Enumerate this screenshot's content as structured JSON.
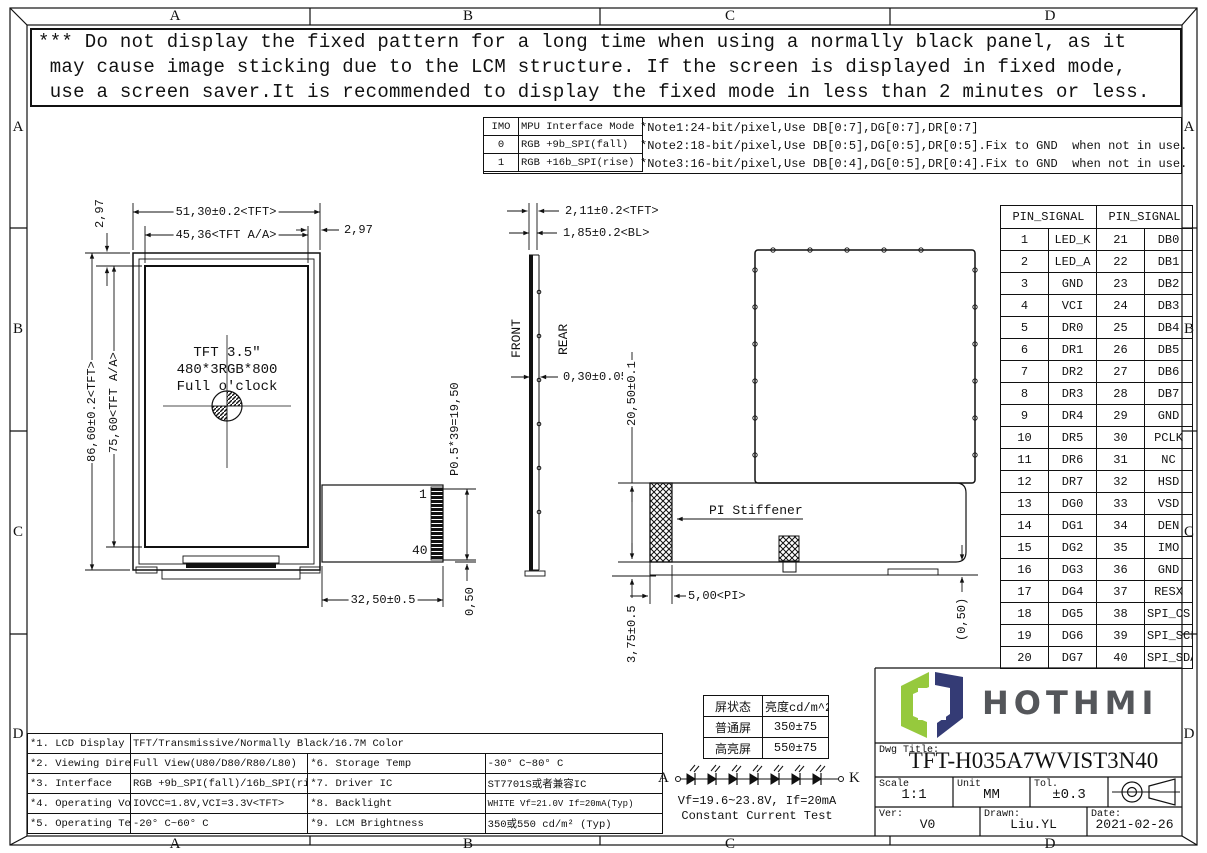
{
  "border": {
    "top": [
      "A",
      "B",
      "C",
      "D"
    ],
    "bottom": [
      "A",
      "B",
      "C",
      "D"
    ],
    "left": [
      "A",
      "B",
      "C",
      "D"
    ],
    "right": [
      "A",
      "B",
      "C",
      "D"
    ]
  },
  "warning": {
    "lines": [
      "*** Do not display the fixed pattern for a long time when using a normally black panel, as it",
      " may cause image sticking due to the LCM structure. If the screen is displayed in fixed mode,",
      " use a screen saver.It is recommended to display the fixed mode in less than 2 minutes or less."
    ]
  },
  "imo_table": {
    "rows": [
      [
        "IMO",
        "MPU Interface Mode"
      ],
      [
        "0",
        "RGB +9b_SPI(fall)"
      ],
      [
        "1",
        "RGB +16b_SPI(rise)"
      ]
    ]
  },
  "notes": {
    "lines": [
      "*Note1:24-bit/pixel,Use DB[0:7],DG[0:7],DR[0:7]",
      "*Note2:18-bit/pixel,Use DB[0:5],DG[0:5],DR[0:5].Fix to GND  when not in use.",
      "*Note3:16-bit/pixel,Use DB[0:4],DG[0:5],DR[0:4].Fix to GND  when not in use."
    ]
  },
  "dims": {
    "w_tft": "51,30±0.2<TFT>",
    "w_aa": "45,36<TFT A/A>",
    "b_l": "2,97",
    "b_r": "2,97",
    "h_tft": "86,60±0.2<TFT>",
    "h_aa": "75,60<TFT A/A>",
    "c1": "TFT 3.5″",
    "c2": "480*3RGB*800",
    "c3": "Full o'clock",
    "pin_first": "1",
    "pin_last": "40",
    "fpc_w": "32,50±0.5",
    "pitch": "P0.5*39=19,50",
    "half": "0,50",
    "t_tft": "2,11±0.2<TFT>",
    "t_bl": "1,85±0.2<BL>",
    "front": "FRONT",
    "rear": "REAR",
    "pol": "0,30±0.05",
    "fold": "20,50±0.1",
    "stiffener": "PI Stiffener",
    "stiff_h": "3,75±0.5",
    "pi_w": "5,00<PI>",
    "ref": "(0,50)"
  },
  "pin_table": {
    "header": [
      "PIN_SIGNAL",
      "PIN_SIGNAL"
    ],
    "rows": [
      [
        "1",
        "LED_K",
        "21",
        "DB0"
      ],
      [
        "2",
        "LED_A",
        "22",
        "DB1"
      ],
      [
        "3",
        "GND",
        "23",
        "DB2"
      ],
      [
        "4",
        "VCI",
        "24",
        "DB3"
      ],
      [
        "5",
        "DR0",
        "25",
        "DB4"
      ],
      [
        "6",
        "DR1",
        "26",
        "DB5"
      ],
      [
        "7",
        "DR2",
        "27",
        "DB6"
      ],
      [
        "8",
        "DR3",
        "28",
        "DB7"
      ],
      [
        "9",
        "DR4",
        "29",
        "GND"
      ],
      [
        "10",
        "DR5",
        "30",
        "PCLK"
      ],
      [
        "11",
        "DR6",
        "31",
        "NC"
      ],
      [
        "12",
        "DR7",
        "32",
        "HSD"
      ],
      [
        "13",
        "DG0",
        "33",
        "VSD"
      ],
      [
        "14",
        "DG1",
        "34",
        "DEN"
      ],
      [
        "15",
        "DG2",
        "35",
        "IMO"
      ],
      [
        "16",
        "DG3",
        "36",
        "GND"
      ],
      [
        "17",
        "DG4",
        "37",
        "RESX"
      ],
      [
        "18",
        "DG5",
        "38",
        "SPI_CS"
      ],
      [
        "19",
        "DG6",
        "39",
        "SPI_SCL"
      ],
      [
        "20",
        "DG7",
        "40",
        "SPI_SDA"
      ]
    ]
  },
  "brightness_table": {
    "header": [
      "屏状态",
      "亮度cd/m^2"
    ],
    "rows": [
      [
        "普通屏",
        "350±75"
      ],
      [
        "高亮屏",
        "550±75"
      ]
    ]
  },
  "led_test": {
    "anode": "A",
    "cathode": "K",
    "line1": "Vf=19.6~23.8V, If=20mA",
    "line2": "Constant Current Test"
  },
  "spec_table": {
    "rows": [
      {
        "l": "*1. LCD Display Type",
        "v": "TFT/Transmissive/Normally Black/16.7M Color",
        "l2": "",
        "v2": ""
      },
      {
        "l": "*2. Viewing Diretion",
        "v": "Full View(U80/D80/R80/L80)",
        "l2": "*6. Storage Temp",
        "v2": "-30° C~80° C"
      },
      {
        "l": "*3. Interface",
        "v": "RGB +9b_SPI(fall)/16b_SPI(rise)",
        "l2": "*7. Driver IC",
        "v2": "ST7701S或者兼容IC"
      },
      {
        "l": "*4. Operating Voltage",
        "v": "IOVCC=1.8V,VCI=3.3V<TFT>",
        "l2": "*8. Backlight",
        "v2": "WHITE Vf=21.0V If=20mA(Typ)"
      },
      {
        "l": "*5. Operating Temp",
        "v": "-20° C~60° C",
        "l2": "*9. LCM Brightness",
        "v2": "350或550 cd/m² (Typ)"
      }
    ]
  },
  "title_block": {
    "brand": "HOTHMI",
    "dwg_title_label": "Dwg Title:",
    "dwg_title": "TFT-H035A7WVIST3N40",
    "scale_label": "Scale",
    "scale": "1:1",
    "unit_label": "Unit",
    "unit": "MM",
    "tol_label": "Tol.",
    "tol": "±0.3",
    "ver_label": "Ver:",
    "ver": "V0",
    "drawn_label": "Drawn:",
    "drawn": "Liu.YL",
    "date_label": "Date:",
    "date": "2021-02-26",
    "colors": {
      "green": "#96c93d",
      "navy": "#343b75",
      "text": "#54565a"
    }
  }
}
